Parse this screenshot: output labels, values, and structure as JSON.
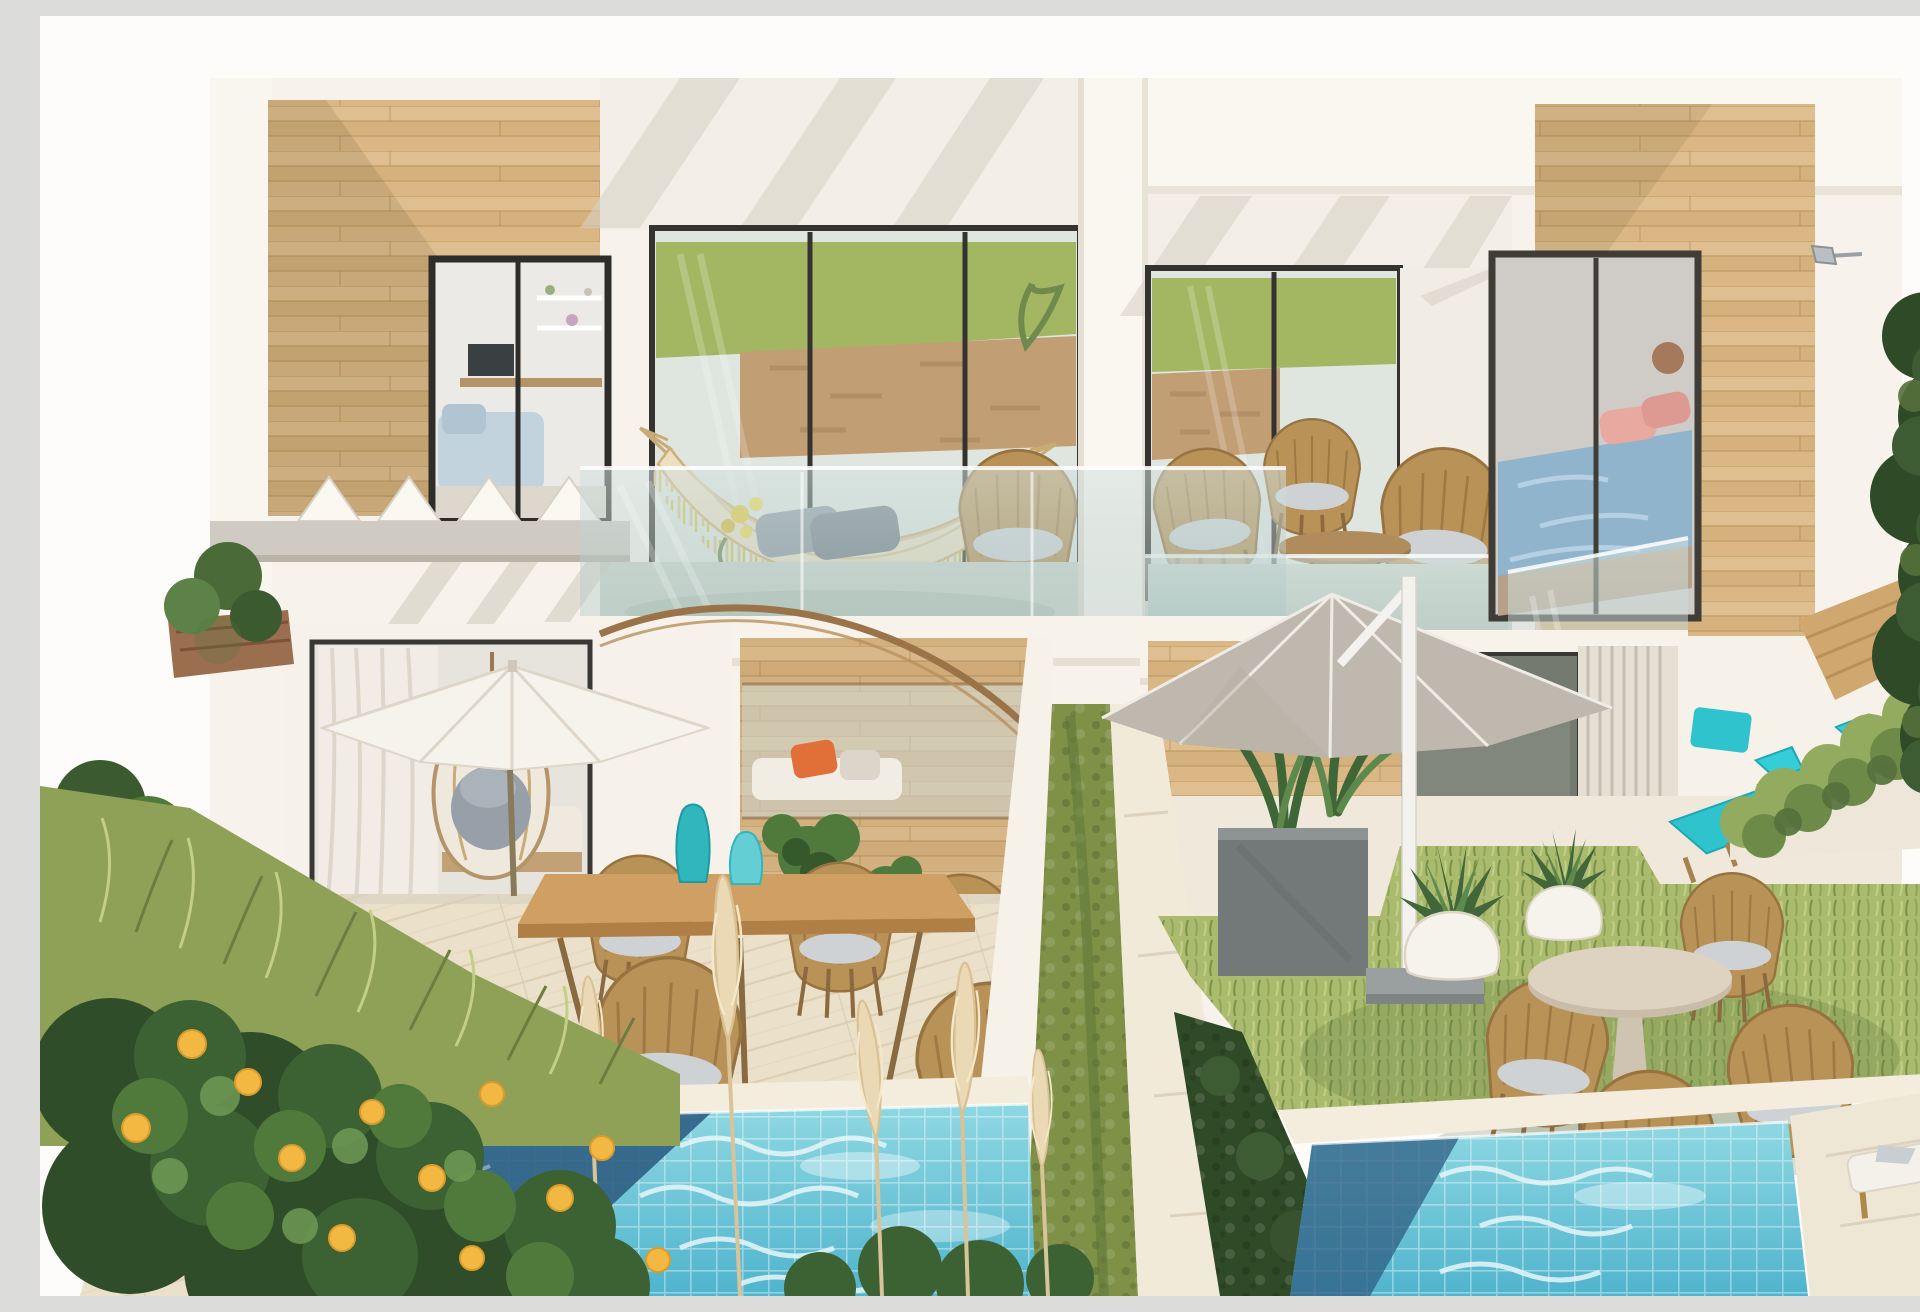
{
  "scene": {
    "setting": "Sunny exterior render of a modern two-unit villa with timber-clad volumes, glass balconies, furnished patios, lawns and two turquoise plunge pools",
    "lighting": "bright midday sun, white hazy sky",
    "view": "elevated frontal view"
  },
  "palette": {
    "sky": "#fdfcfa",
    "wall-white": "#f7f3ec",
    "wall-shade": "#efe8dd",
    "wood-light": "#dcbc8c",
    "wood-mid": "#d3b07c",
    "wood-line": "#b99258",
    "glass-tint": "#cfdcd8",
    "reflection-grass": "#a3b763",
    "reflection-stone": "#c29e74",
    "balcony-floor": "#ccd5cb",
    "deck": "#ebe0ca",
    "stone-paving": "#f2ead9",
    "pool-water": "#63c6d8",
    "pool-shadow": "#2f5e83",
    "grass": "#aabb6e",
    "hedge": "#44632f",
    "hedge-dark": "#2f4a26",
    "umbrella-white": "#f6f3ec",
    "umbrella-gray": "#c9c3ba",
    "wicker": "#b99257",
    "cushion-gray": "#ced2d4",
    "teak": "#cf9f63",
    "accent-teal": "#2fb7bd",
    "accent-cyan": "#2fc3ce",
    "accent-orange": "#e07038",
    "accent-yellow": "#d8c23e",
    "lemon": "#f2b841",
    "bedding-blue": "#8fb4cc",
    "pillow-pink": "#e8a9a0",
    "pampas": "#ead9b4"
  },
  "building": {
    "floors": 2,
    "units": 2,
    "materials": [
      "white render",
      "horizontal timber cladding",
      "frameless glass balustrades",
      "dark aluminium frames",
      "concrete pergola beam"
    ],
    "upper_level": {
      "left_balcony": [
        "fringed hammock with yellow tassels",
        "gray cushions and yellow flowers",
        "rope armchair",
        "sliding glass doors reflecting lawn and stone wall",
        "round rug"
      ],
      "right_balcony": [
        "three rope armchairs with gray cushions",
        "oval timber coffee table",
        "sliding glass doors",
        "glass corner balustrade"
      ],
      "bedroom_window": [
        "bed with light-blue duvet",
        "blush pillows",
        "timber surround"
      ],
      "exterior_lamp": "small gray wall spotlight"
    },
    "ground_level": {
      "left_patio": [
        "white cantilever parasol",
        "teak dining table",
        "two teal vases",
        "rope dining chairs with gray cushions",
        "hanging egg chair behind glazing",
        "sheer curtains",
        "charcoal cube planters",
        "timber privacy wall",
        "daybed nook with orange pillow",
        "bronze curved rail"
      ],
      "right_garden": [
        "gray cantilever parasol with white mast and base",
        "round pedestal table",
        "four rope chairs with ivory cushions",
        "two white egg planters with agaves",
        "two sun loungers with cyan cushions",
        "charcoal trough planter with dracaena",
        "cascading planter wall",
        "timber fence"
      ]
    }
  },
  "landscape": {
    "pools": [
      {
        "name": "left plunge pool",
        "finish": "turquoise mosaic tile",
        "feature": "deep shade across left corner"
      },
      {
        "name": "right plunge pool",
        "finish": "turquoise mosaic tile",
        "feature": "hedge shadow along left edge"
      }
    ],
    "vegetation": [
      "lemon tree with ripe fruit",
      "ornamental meadow grasses",
      "pampas plumes",
      "clipped hedge divider strip",
      "tall dark boundary hedge",
      "potted tropical plants"
    ],
    "hardscape": [
      "whitewashed timber deck",
      "pale stone paving walkway",
      "angled white garden walls"
    ]
  }
}
